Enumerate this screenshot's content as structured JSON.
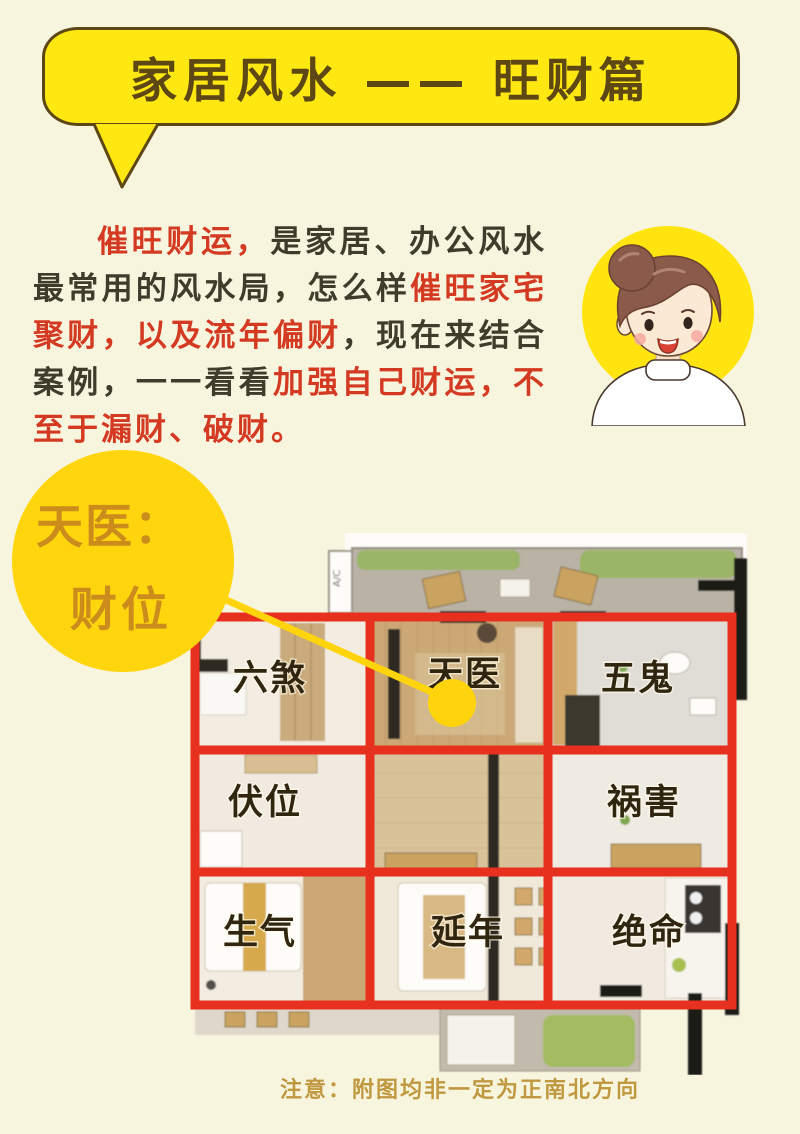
{
  "header": {
    "title": "家居风水 —— 旺财篇"
  },
  "intro": {
    "lines": [
      {
        "indent": true,
        "justify": true,
        "segs": [
          {
            "t": "催旺财运，",
            "s": "red-bold"
          },
          {
            "t": "是家居、办公风水",
            "s": "dark"
          }
        ]
      },
      {
        "justify": true,
        "segs": [
          {
            "t": "最常用的风水局，怎么样",
            "s": "dark"
          },
          {
            "t": "催旺家宅",
            "s": "red"
          }
        ]
      },
      {
        "justify": true,
        "segs": [
          {
            "t": "聚财，以及流年偏财",
            "s": "red"
          },
          {
            "t": "，现在来结合",
            "s": "dark"
          }
        ]
      },
      {
        "justify": true,
        "segs": [
          {
            "t": "案例，一一看看",
            "s": "dark"
          },
          {
            "t": "加强自己财运，不",
            "s": "red-bold"
          }
        ]
      },
      {
        "segs": [
          {
            "t": "至于漏财、破财。",
            "s": "red-bold"
          }
        ]
      }
    ]
  },
  "callout": {
    "line1": "天医：",
    "line2": "财位"
  },
  "plan": {
    "labels": [
      {
        "id": "liusha",
        "text": "六煞"
      },
      {
        "id": "tianyi",
        "text": "天医"
      },
      {
        "id": "wugui",
        "text": "五鬼"
      },
      {
        "id": "fuwei",
        "text": "伏位"
      },
      {
        "id": "huohai",
        "text": "祸害"
      },
      {
        "id": "shengqi",
        "text": "生气"
      },
      {
        "id": "yannian",
        "text": "延年"
      },
      {
        "id": "jueming",
        "text": "绝命"
      }
    ],
    "ac_label": "A/C"
  },
  "footer": {
    "note": "注意：附图均非一定为正南北方向"
  },
  "colors": {
    "page_bg": "#F8F5DF",
    "bubble_yellow": "#FFE812",
    "callout_yellow": "#FFD60E",
    "title_brown": "#5C4715",
    "body_dark": "#3F3C2B",
    "body_red": "#D43A22",
    "grid_red": "#E8301F",
    "label_brown": "#30250F",
    "callout_text": "#CC8C1B",
    "note_gold": "#C0983F"
  },
  "icons": {
    "avatar": "woman-avatar",
    "annotation": "pointer-line-and-dot"
  }
}
